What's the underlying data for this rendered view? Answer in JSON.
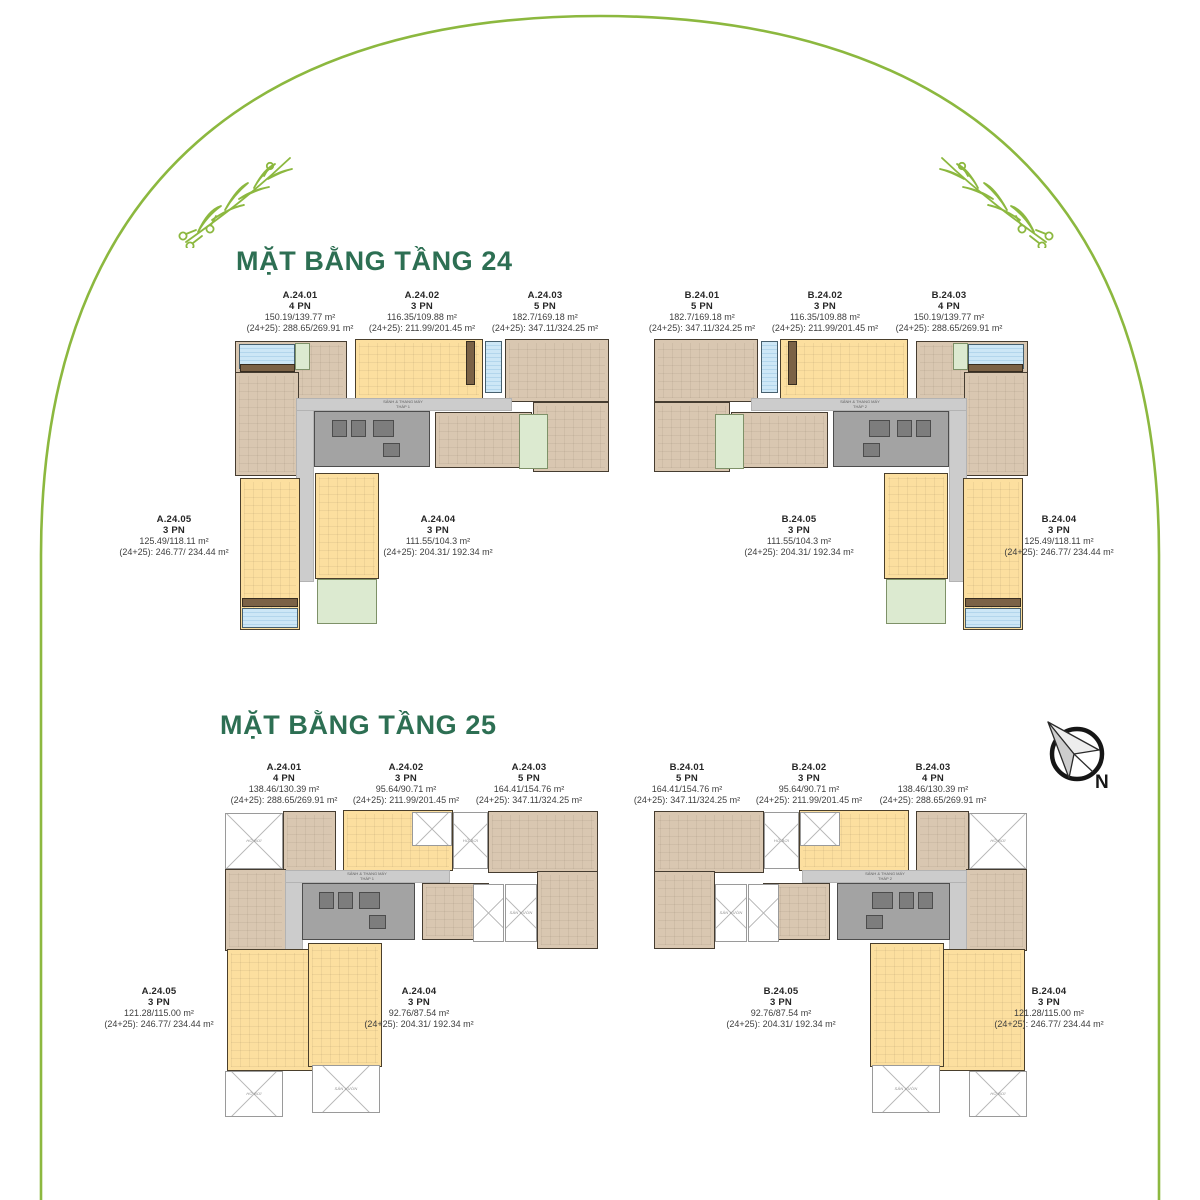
{
  "titles": {
    "floor24": "MẶT BẰNG TẦNG 24",
    "floor25": "MẶT BẰNG TẦNG 25"
  },
  "compass": {
    "label": "N"
  },
  "annotations": {
    "lobby": "SẢNH & THANG MÁY",
    "tower1": "THÁP 1",
    "tower2": "THÁP 2",
    "pool": "HỒ BƠI",
    "garden": "SÂN VƯỜN"
  },
  "colors": {
    "title_green": "#2d6f53",
    "arch_green": "#8cb83f",
    "unit_yellow": "#fcdf9f",
    "unit_tan": "#d9c7b1",
    "pool_blue": "#cde7f6",
    "garden_green": "#dcead0",
    "corridor_gray": "#cccccc",
    "core_gray": "#a3a3a3"
  },
  "floor24": {
    "a": {
      "u1": {
        "name": "A.24.01",
        "pn": "4 PN",
        "area": "150.19/139.77 m²",
        "combined": "(24+25): 288.65/269.91 m²"
      },
      "u2": {
        "name": "A.24.02",
        "pn": "3 PN",
        "area": "116.35/109.88 m²",
        "combined": "(24+25): 211.99/201.45 m²"
      },
      "u3": {
        "name": "A.24.03",
        "pn": "5 PN",
        "area": "182.7/169.18 m²",
        "combined": "(24+25): 347.11/324.25 m²"
      },
      "u4": {
        "name": "A.24.04",
        "pn": "3 PN",
        "area": "111.55/104.3 m²",
        "combined": "(24+25): 204.31/ 192.34 m²"
      },
      "u5": {
        "name": "A.24.05",
        "pn": "3 PN",
        "area": "125.49/118.11 m²",
        "combined": "(24+25): 246.77/ 234.44 m²"
      }
    },
    "b": {
      "u1": {
        "name": "B.24.01",
        "pn": "5 PN",
        "area": "182.7/169.18 m²",
        "combined": "(24+25): 347.11/324.25 m²"
      },
      "u2": {
        "name": "B.24.02",
        "pn": "3 PN",
        "area": "116.35/109.88 m²",
        "combined": "(24+25): 211.99/201.45 m²"
      },
      "u3": {
        "name": "B.24.03",
        "pn": "4 PN",
        "area": "150.19/139.77 m²",
        "combined": "(24+25): 288.65/269.91 m²"
      },
      "u4": {
        "name": "B.24.04",
        "pn": "3 PN",
        "area": "125.49/118.11 m²",
        "combined": "(24+25): 246.77/ 234.44 m²"
      },
      "u5": {
        "name": "B.24.05",
        "pn": "3 PN",
        "area": "111.55/104.3 m²",
        "combined": "(24+25): 204.31/ 192.34 m²"
      }
    }
  },
  "floor25": {
    "a": {
      "u1": {
        "name": "A.24.01",
        "pn": "4 PN",
        "area": "138.46/130.39 m²",
        "combined": "(24+25): 288.65/269.91 m²"
      },
      "u2": {
        "name": "A.24.02",
        "pn": "3 PN",
        "area": "95.64/90.71 m²",
        "combined": "(24+25): 211.99/201.45 m²"
      },
      "u3": {
        "name": "A.24.03",
        "pn": "5 PN",
        "area": "164.41/154.76 m²",
        "combined": "(24+25): 347.11/324.25 m²"
      },
      "u4": {
        "name": "A.24.04",
        "pn": "3 PN",
        "area": "92.76/87.54 m²",
        "combined": "(24+25): 204.31/ 192.34 m²"
      },
      "u5": {
        "name": "A.24.05",
        "pn": "3 PN",
        "area": "121.28/115.00 m²",
        "combined": "(24+25): 246.77/ 234.44 m²"
      }
    },
    "b": {
      "u1": {
        "name": "B.24.01",
        "pn": "5 PN",
        "area": "164.41/154.76 m²",
        "combined": "(24+25): 347.11/324.25 m²"
      },
      "u2": {
        "name": "B.24.02",
        "pn": "3 PN",
        "area": "95.64/90.71 m²",
        "combined": "(24+25): 211.99/201.45 m²"
      },
      "u3": {
        "name": "B.24.03",
        "pn": "4 PN",
        "area": "138.46/130.39 m²",
        "combined": "(24+25): 288.65/269.91 m²"
      },
      "u4": {
        "name": "B.24.04",
        "pn": "3 PN",
        "area": "121.28/115.00 m²",
        "combined": "(24+25): 246.77/ 234.44 m²"
      },
      "u5": {
        "name": "B.24.05",
        "pn": "3 PN",
        "area": "92.76/87.54 m²",
        "combined": "(24+25): 204.31/ 192.34 m²"
      }
    }
  }
}
